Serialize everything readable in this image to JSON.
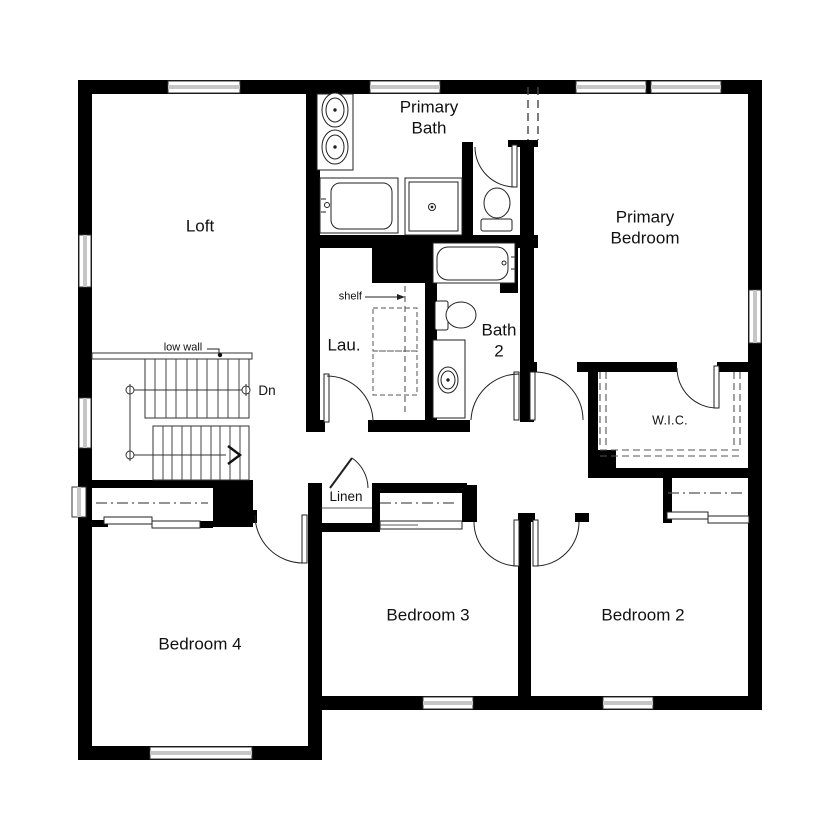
{
  "floorplan": {
    "rooms": {
      "loft": "Loft",
      "primary_bath": "Primary\nBath",
      "primary_bedroom": "Primary\nBedroom",
      "laundry": "Lau.",
      "bath2": "Bath\n2",
      "wic": "W.I.C.",
      "linen": "Linen",
      "bedroom4": "Bedroom 4",
      "bedroom3": "Bedroom 3",
      "bedroom2": "Bedroom 2"
    },
    "annotations": {
      "shelf": "shelf",
      "low_wall": "low wall",
      "down": "Dn"
    },
    "colors": {
      "wall": "#000000",
      "line": "#222222",
      "dashed": "#555555",
      "background": "#ffffff"
    }
  }
}
